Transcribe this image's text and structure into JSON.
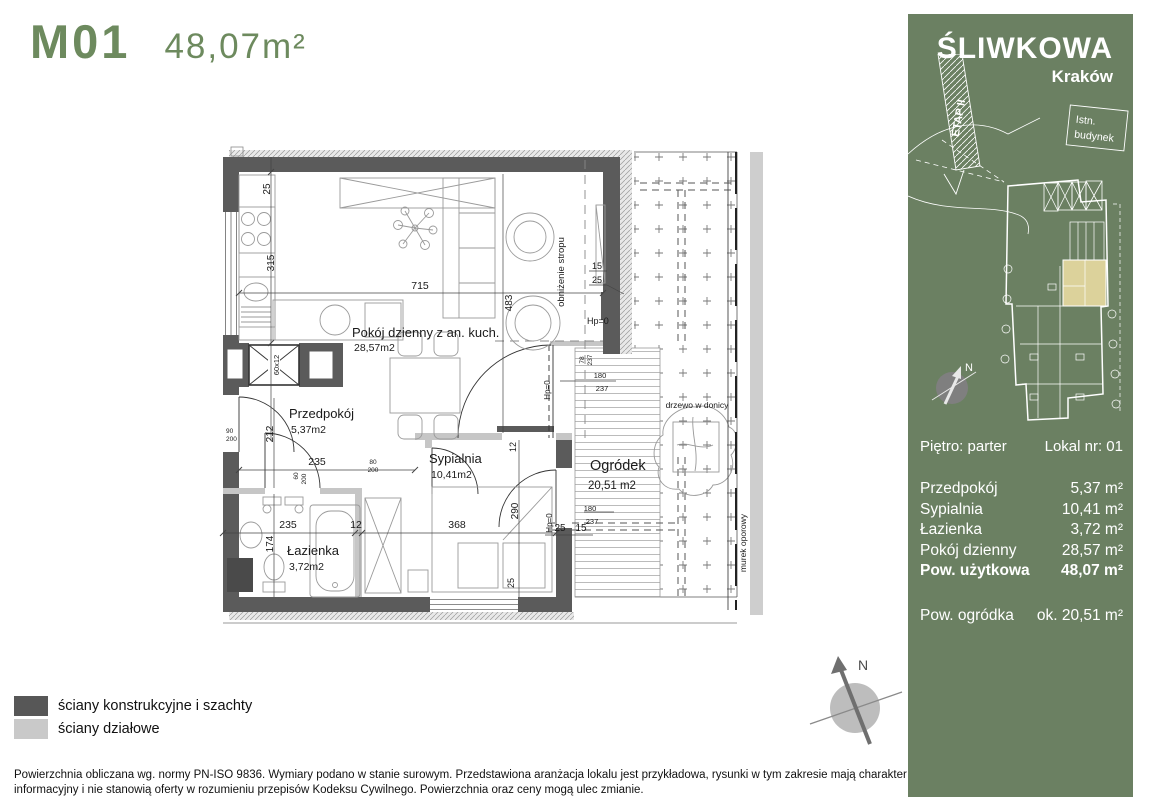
{
  "header": {
    "unit_code": "M01",
    "area": "48,07m²"
  },
  "plan": {
    "rooms": {
      "living": {
        "name": "Pokój dzienny z an. kuch.",
        "area": "28,57m2"
      },
      "hall": {
        "name": "Przedpokój",
        "area": "5,37m2"
      },
      "bedroom": {
        "name": "Sypialnia",
        "area": "10,41m2"
      },
      "bath": {
        "name": "Łazienka",
        "area": "3,72m2"
      },
      "garden": {
        "name": "Ogródek",
        "area": "20,51  m2"
      }
    },
    "annotations": {
      "lowered_ceiling": "obniżenie stropu",
      "hp0": "Hp=0",
      "tree": "drzewo w donicy",
      "retaining_wall": "murek oporowy",
      "shaft": "60x12"
    },
    "dims": {
      "d25": "25",
      "d315": "315",
      "d715": "715",
      "d483": "483",
      "d15": "15",
      "d212": "212",
      "d235": "235",
      "d12": "12",
      "d368": "368",
      "d174": "174",
      "d290": "290",
      "d80": "80",
      "d200": "200",
      "d90": "90",
      "d60": "60",
      "d78": "78",
      "d237": "237",
      "d180": "180"
    }
  },
  "legend": {
    "items": [
      {
        "label": "ściany konstrukcyjne i szachty",
        "color": "#575757"
      },
      {
        "label": "ściany działowe",
        "color": "#c9c9c9"
      }
    ]
  },
  "compass": {
    "north": "N"
  },
  "disclaimer": {
    "line1": "Powierzchnia obliczana wg. normy PN-ISO 9836. Wymiary podano w stanie surowym. Przedstawiona aranżacja lokalu jest przykładowa, rysunki w tym zakresie mają charakter",
    "line2": "informacyjny i nie stanowią oferty w rozumieniu przepisów Kodeksu Cywilnego. Powierzchnia oraz ceny mogą ulec zmianie."
  },
  "sidebar": {
    "background_color": "#6b8062",
    "highlight_color": "#dcd29b",
    "project": "ŚLIWKOWA",
    "city": "Kraków",
    "siteplan": {
      "stage": "ETAP II",
      "existing_line1": "Istn.",
      "existing_line2": "budynek",
      "north": "N"
    },
    "floor_label": "Piętro: parter",
    "unit_label": "Lokal nr: 01",
    "rooms": [
      {
        "name": "Przedpokój",
        "area": "5,37 m²"
      },
      {
        "name": "Sypialnia",
        "area": "10,41 m²"
      },
      {
        "name": "Łazienka",
        "area": "3,72 m²"
      },
      {
        "name": "Pokój dzienny",
        "area": "28,57 m²"
      }
    ],
    "total": {
      "name": "Pow. użytkowa",
      "area": "48,07 m²"
    },
    "garden": {
      "name": "Pow. ogródka",
      "area": "ok. 20,51 m²"
    }
  }
}
